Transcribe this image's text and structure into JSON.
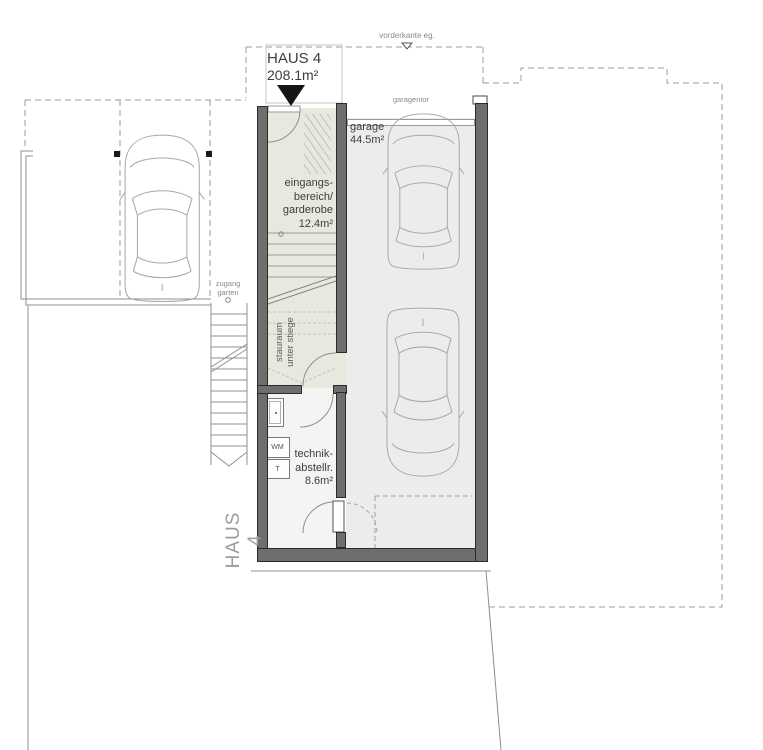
{
  "plan": {
    "name": "HAUS 4",
    "area": "208.1m²",
    "side_label": "HAUS 4",
    "levels": {
      "vorderkante": "vorderkante eg."
    },
    "garage": {
      "label": "garage\n44.5m²",
      "door_label": "garagentor"
    },
    "eingang": {
      "label": "eingangs-\nbereich/\ngarderobe\n12.4m²"
    },
    "stauraum": {
      "label": "stauraum\nunter stiege"
    },
    "technik": {
      "label": "technik-\nabstellr.\n8.6m²"
    },
    "zugang": {
      "label": "zugang\ngarten"
    },
    "fixtures": {
      "wm": "WM",
      "t": "T"
    },
    "colors": {
      "wall": "#6e6e6e",
      "hall_floor": "#e6eade",
      "garage_floor": "#ececeb",
      "technik_floor": "#f4f4f3",
      "line": "#8f8f8f",
      "dashed": "#9b9b9b",
      "label": "#3d3d3d",
      "muted": "#8a8a8a",
      "marker": "#151515"
    }
  }
}
